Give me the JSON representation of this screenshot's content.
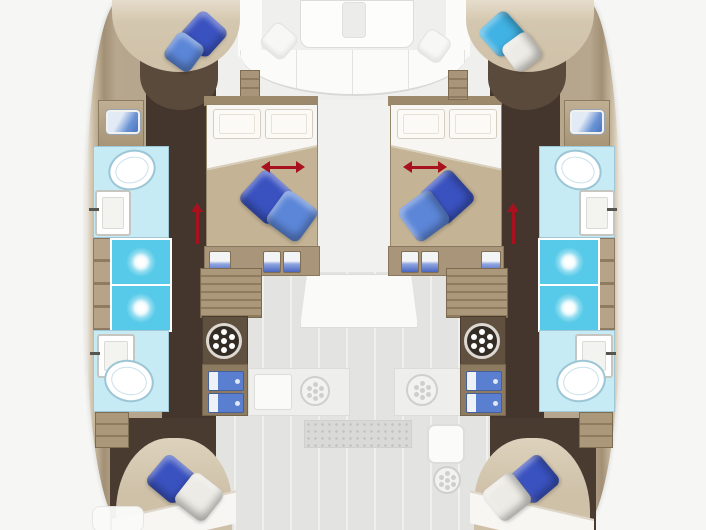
{
  "figure": {
    "kind": "yacht-floorplan",
    "vessel_type": "catamaran",
    "view": "top-down interior deck plan",
    "text_content": "none (image contains no text)"
  },
  "colors": {
    "bg": "#f6f6f5",
    "hullWood": "#b6a78e",
    "floorDark": "#44362c",
    "floorAft": "#4a3b31",
    "bedFootBrown": "#5a4a3c",
    "bedTan": "#cfc1a8",
    "blanketTan": "#c4b394",
    "sheetWhite": "#f7f6f3",
    "furnitureTan": "#a9967a",
    "furnitureEdge": "#8a785e",
    "stairWood": "#ab977a",
    "stairLine": "#8f7c5e",
    "cabinetDark": "#5f5040",
    "pillowNavy": "#3a52c0",
    "pillowBlue": "#5c86d8",
    "pillowCyan": "#41b2e4",
    "pillowWhite": "#edebe5",
    "bathFloor": "#c6ebf5",
    "bathEdge": "#9cc6d6",
    "showerCyan": "#56cae8",
    "drawerBlue": "#5b7fd0",
    "ghostFloor": "#e3e3e1",
    "ghostFill": "#efefee",
    "ghostWhite": "#fbfbfa",
    "ghostLine": "#dcdcda",
    "arrowRed": "#a8121f"
  },
  "zones": {
    "port_hull": {
      "bow_cabin": {
        "bed": "double-bed",
        "pillows": [
          "navy-pillow",
          "blue-pillow"
        ]
      },
      "forward_bathroom": {
        "fixtures": [
          "vanity-sink",
          "toilet",
          "sink"
        ]
      },
      "shower_room": {
        "fixtures": [
          "shower-stall",
          "shower-stall",
          "shelving"
        ]
      },
      "aft_bathroom": {
        "fixtures": [
          "sink",
          "toilet",
          "cabinet"
        ]
      },
      "aft_cabin": {
        "bed": "double-bed",
        "pillows": [
          "navy-pillow",
          "white-pillow"
        ]
      },
      "utilities": [
        "companionway-stairs",
        "washing-machine",
        "storage-drawers",
        "lockers"
      ]
    },
    "starboard_hull": {
      "bow_cabin": {
        "bed": "double-bed",
        "pillows": [
          "cyan-pillow",
          "white-pillow"
        ]
      },
      "forward_bathroom": {
        "fixtures": [
          "vanity-sink",
          "toilet",
          "sink"
        ]
      },
      "shower_room": {
        "fixtures": [
          "shower-stall",
          "shower-stall",
          "shelving"
        ]
      },
      "aft_bathroom": {
        "fixtures": [
          "sink",
          "toilet",
          "cabinet"
        ]
      },
      "aft_cabin": {
        "bed": "double-bed",
        "pillows": [
          "navy-pillow",
          "white-pillow"
        ]
      },
      "utilities": [
        "companionway-stairs",
        "washing-machine",
        "storage-drawers",
        "lockers"
      ]
    },
    "center_deck": {
      "salon_ghost": [
        "sofa",
        "table",
        "white-pillow",
        "white-pillow"
      ],
      "port_center_cabin": {
        "bed": "convertible-double-bed",
        "pillows": [
          "white-headboard-pillows",
          "navy-pillow",
          "blue-pillow"
        ],
        "indicator": "red-extension-arrow"
      },
      "starboard_center_cabin": {
        "bed": "convertible-double-bed",
        "pillows": [
          "white-headboard-pillows",
          "navy-pillow",
          "blue-pillow"
        ],
        "indicator": "red-extension-arrow"
      },
      "galley_ghost": [
        "counter",
        "sink",
        "hob",
        "stove",
        "sink",
        "burner",
        "floor-grate",
        "entry-steps"
      ],
      "indicators": [
        "red-companionway-arrow-port",
        "red-companionway-arrow-starboard"
      ]
    }
  }
}
